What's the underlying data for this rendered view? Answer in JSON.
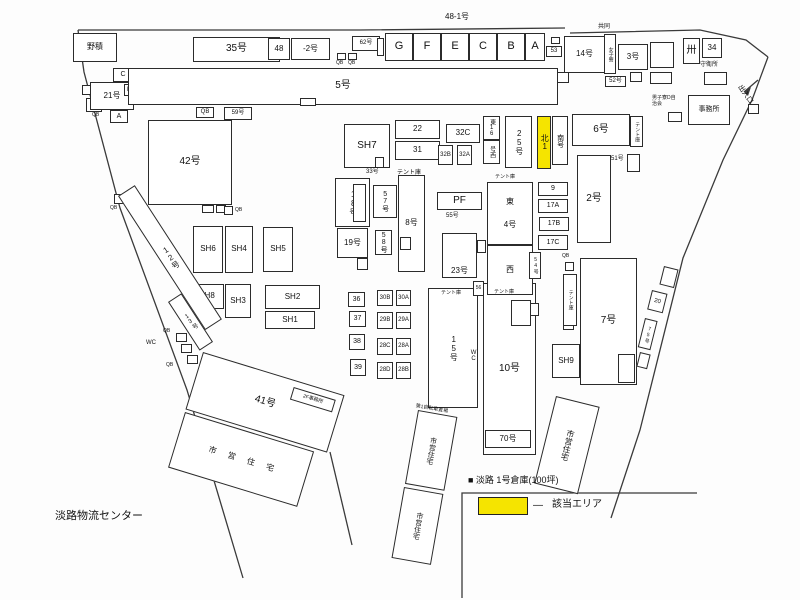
{
  "site_name": "淡路物流センター",
  "legend": {
    "item": "■ 淡路 1号倉庫(100坪)",
    "dash": "—",
    "area_label": "該当エリア",
    "highlight_color": "#f5e400"
  },
  "cells": [
    "G",
    "F",
    "E",
    "C",
    "B",
    "A"
  ],
  "labels": {
    "yard": "野積",
    "b21": "21号",
    "u_c": "C",
    "u_b": "B",
    "u_a": "A",
    "qb": "QB",
    "b35": "35号",
    "b48": "48",
    "b48_2": "-2号",
    "b48_1": "48-1号",
    "b62": "62号",
    "b53": "53",
    "b14": "14号",
    "girls_dorm": "女子寮",
    "b52": "52号",
    "b3": "3号",
    "kyodo": "共同",
    "hatch": "卅",
    "b34": "34",
    "guard": "守衛所",
    "office": "事務所",
    "mens_dorm": "男子寮D自治会",
    "entrance": "出入口",
    "b5": "5号",
    "b59": "59号",
    "b42": "42号",
    "b22": "22",
    "b31": "31",
    "b32c": "32C",
    "b32b": "32B",
    "b32a": "32A",
    "sh7": "SH7",
    "b33": "33号",
    "tent": "テント庫",
    "b18": "18号",
    "b57": "57号",
    "b19": "19号",
    "b58": "58号",
    "b8": "8号",
    "pf": "PF",
    "b55": "55号",
    "b23": "23号",
    "b36": "36",
    "b37": "37",
    "b38": "38",
    "b39": "39",
    "b30b": "30B",
    "b30a": "30A",
    "b29b": "29B",
    "b29a": "29A",
    "b28c": "28C",
    "b28a": "28A",
    "b28d": "28D",
    "b28b": "28B",
    "b15": "15号",
    "wc": "WC",
    "b56": "56",
    "b10": "10号",
    "b70": "70号",
    "bike": "第1自転車置場",
    "e16": "東16",
    "e16w": "号西",
    "b25": "25号",
    "north1": "北1",
    "south": "南号",
    "b6": "6号",
    "b51": "51号",
    "b2": "2号",
    "b9": "9",
    "b17a": "17A",
    "b17b": "17B",
    "b17c": "17C",
    "east": "東",
    "b4": "4号",
    "west": "西",
    "b54": "54号",
    "sh9": "SH9",
    "b7": "7号",
    "b20": "20",
    "b75": "75号",
    "sh6": "SH6",
    "sh4": "SH4",
    "sh5": "SH5",
    "sh8": "SH8",
    "sh3": "SH3",
    "sh2": "SH2",
    "sh1": "SH1",
    "b12": "12号",
    "b13": "13号",
    "b41": "41号",
    "office2f": "2F事務所",
    "municipal": "市営住宅"
  }
}
